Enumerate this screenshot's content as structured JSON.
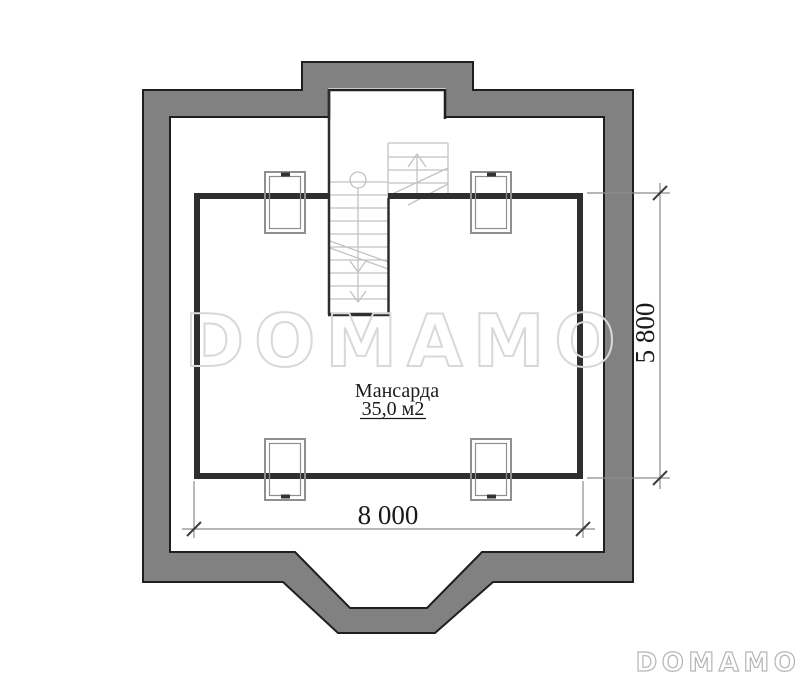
{
  "plan": {
    "room": {
      "name": "Мансарда",
      "area": "35,0 м2"
    },
    "dimensions": {
      "horizontal": "8 000",
      "vertical": "5 800"
    }
  },
  "watermark": {
    "text": "DOMAMO"
  },
  "brand": {
    "logo_text": "DOMAMO"
  },
  "colors": {
    "wall_fill": "#818181",
    "outline_dark": "#1f1f1f",
    "room_wall": "#2e2e2e",
    "stair_line": "#c2c2c2",
    "window_line": "#8f8f8f",
    "window_tick": "#333333",
    "dimension_line": "#8c8c8c",
    "dimension_tick": "#3d3d3d",
    "dimension_text": "#1a1a1a",
    "watermark": "#d8d8d8",
    "logo": "#b5b5b5",
    "background": "#ffffff"
  }
}
